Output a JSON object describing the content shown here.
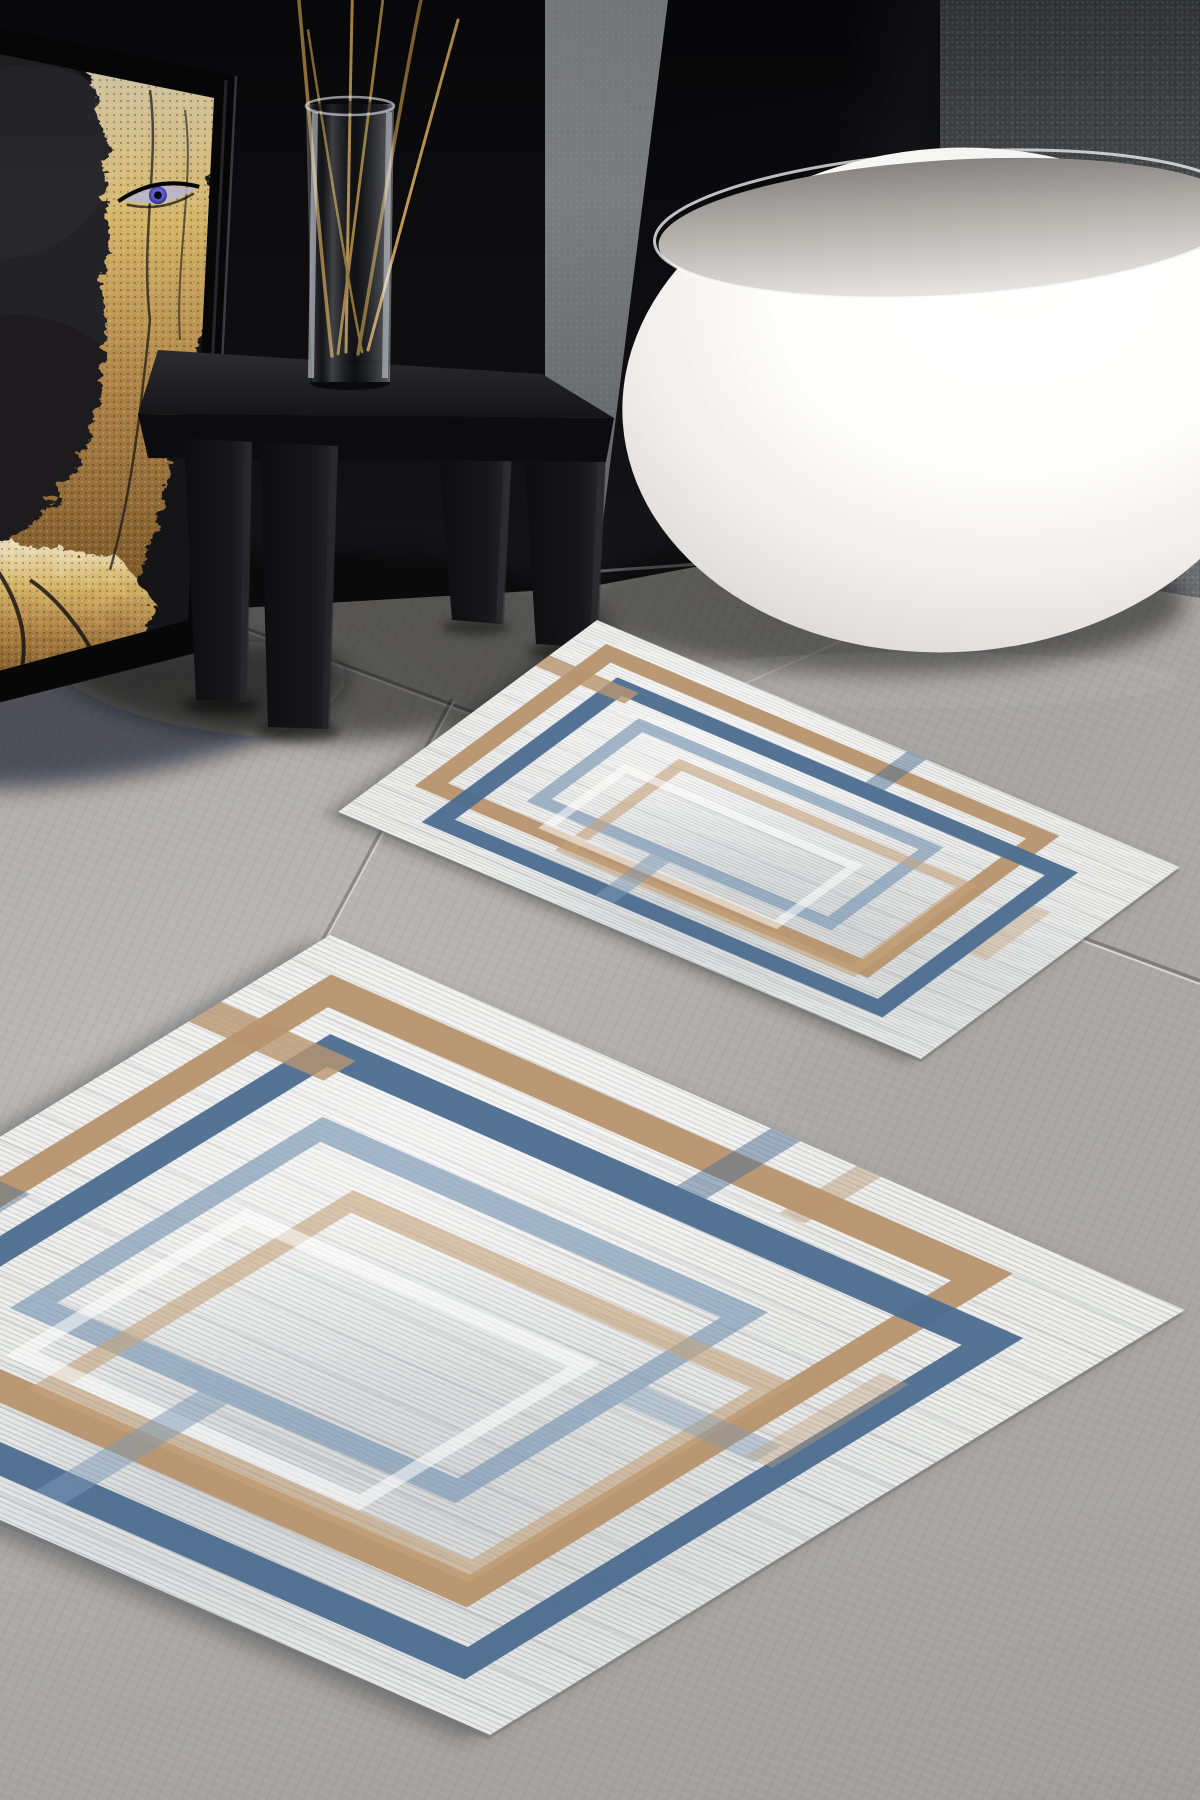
{
  "scene": {
    "type": "product-photograph",
    "setting": "modern bathroom with dark walls and gray tile floor",
    "subject": "Two-piece geometric bath mat set (large and small rug)",
    "objects": [
      "framed-gold-leaf-portrait-artwork",
      "black-wooden-stool",
      "glass-vase-with-gold-twigs",
      "white-freestanding-bathtub",
      "gray-tile-floor",
      "small-bath-mat",
      "large-bath-mat"
    ]
  },
  "palette": {
    "rug-blue": "#4d6d91",
    "rug-faded-blue": "#7e99b5",
    "rug-tan": "#b8956f",
    "rug-faded-tan": "#c5a37c",
    "rug-base": "#ecedeb",
    "floor-gray": "#a8a7a5",
    "wall-black": "#0c0c0e",
    "wall-gray": "#5a5b5d",
    "tub-white": "#fbfbfa",
    "gold": "#c9a351",
    "eye-blue": "#5552c5"
  },
  "rugs": {
    "large": {
      "name": "large-bath-mat",
      "shape": "rectangle seen in perspective",
      "pattern": "offset interlocking rectangular frames",
      "frame_colors": [
        "tan",
        "blue",
        "faded-blue",
        "faded-tan",
        "white"
      ]
    },
    "small": {
      "name": "small-bath-mat",
      "shape": "rectangle seen in perspective",
      "pattern": "offset interlocking rectangular frames",
      "frame_colors": [
        "tan",
        "blue",
        "faded-blue",
        "faded-tan",
        "white"
      ]
    }
  }
}
